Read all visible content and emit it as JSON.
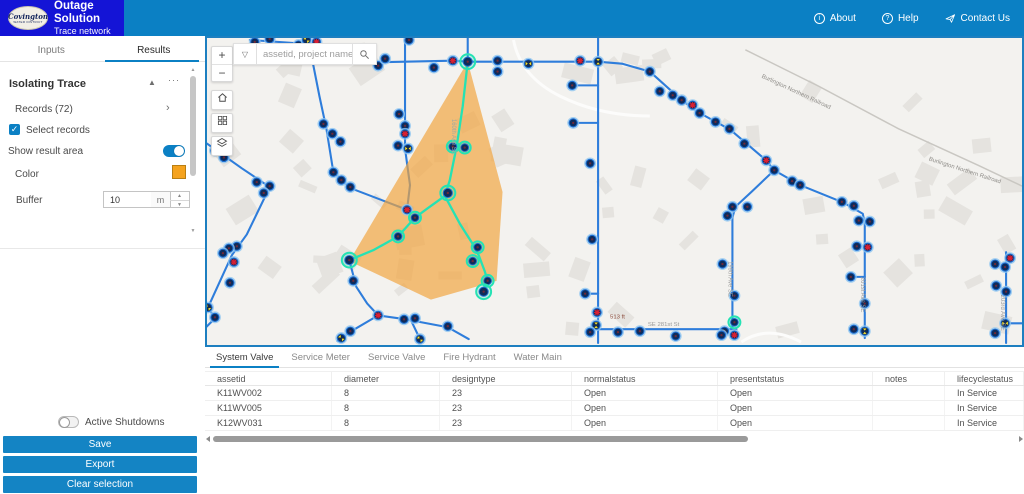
{
  "header": {
    "logo_line1": "Covington",
    "logo_line2": "WATER DISTRICT",
    "app_title": "Outage Solution",
    "app_subtitle": "Trace network",
    "links": [
      {
        "label": "About"
      },
      {
        "label": "Help"
      },
      {
        "label": "Contact Us"
      }
    ]
  },
  "sidebar": {
    "tabs": [
      {
        "label": "Inputs",
        "active": false
      },
      {
        "label": "Results",
        "active": true
      }
    ],
    "panel_title": "Isolating Trace",
    "records_label": "Records (72)",
    "select_records_label": "Select records",
    "select_records_checked": true,
    "show_result_area_label": "Show result area",
    "show_result_area_on": true,
    "color_label": "Color",
    "color_value": "#f5a31e",
    "buffer_label": "Buffer",
    "buffer_value": "10",
    "buffer_unit": "m",
    "active_shutdowns_label": "Active Shutdowns",
    "active_shutdowns_on": false,
    "buttons": [
      {
        "label": "Save"
      },
      {
        "label": "Export"
      },
      {
        "label": "Clear selection"
      }
    ]
  },
  "map": {
    "search_placeholder": "assetid, project name",
    "labels": [
      {
        "text": "Burlington Northern Railroad",
        "x": 762,
        "y": 76,
        "r": 25,
        "c": "#8f8d89"
      },
      {
        "text": "Burlington Northern Railroad",
        "x": 930,
        "y": 160,
        "r": 18,
        "c": "#8f8d89"
      },
      {
        "text": "SE 281st St",
        "x": 648,
        "y": 328,
        "r": 0,
        "c": "#9a9a9a"
      },
      {
        "text": "513 ft",
        "x": 610,
        "y": 320,
        "r": 0,
        "c": "#8a4a3a"
      },
      {
        "text": "SE 277th Pl",
        "x": 340,
        "y": 56,
        "r": 0,
        "c": "#a0a0a0"
      },
      {
        "text": "160th Ave SE",
        "x": 451,
        "y": 118,
        "r": 90,
        "c": "#a0a8a0"
      },
      {
        "text": "199th Ave SE",
        "x": 729,
        "y": 262,
        "r": 90,
        "c": "#9a9a9a"
      },
      {
        "text": "201st Ave SE",
        "x": 862,
        "y": 278,
        "r": 90,
        "c": "#9a9a9a"
      },
      {
        "text": "203rd Ave SE",
        "x": 1003,
        "y": 296,
        "r": 90,
        "c": "#9a9a9a"
      }
    ],
    "railroad": [
      [
        746,
        48
      ],
      [
        820,
        85
      ],
      [
        900,
        128
      ],
      [
        980,
        165
      ],
      [
        1024,
        186
      ]
    ],
    "roads": [
      "M513,38 Q520,75 560,95 T650,115",
      "M742,344 Q768,326 802,344"
    ],
    "polygon": [
      [
        467,
        60
      ],
      [
        502,
        192
      ],
      [
        496,
        282
      ],
      [
        430,
        301
      ],
      [
        348,
        262
      ]
    ],
    "lines": [
      [
        [
          358,
          61
        ],
        [
          452,
          59
        ],
        [
          467,
          60
        ],
        [
          598,
          60
        ],
        [
          622,
          62
        ]
      ],
      [
        [
          622,
          62
        ],
        [
          650,
          70
        ],
        [
          682,
          99
        ],
        [
          700,
          112
        ],
        [
          731,
          129
        ],
        [
          767,
          160
        ],
        [
          775,
          170
        ]
      ],
      [
        [
          775,
          170
        ],
        [
          801,
          185
        ],
        [
          845,
          203
        ],
        [
          864,
          214
        ],
        [
          866,
          224
        ],
        [
          866,
          340
        ]
      ],
      [
        [
          852,
          278
        ],
        [
          866,
          278
        ]
      ],
      [
        [
          775,
          170
        ],
        [
          752,
          192
        ],
        [
          736,
          207
        ],
        [
          733,
          218
        ],
        [
          733,
          331
        ]
      ],
      [
        [
          598,
          331
        ],
        [
          737,
          331
        ]
      ],
      [
        [
          598,
          36
        ],
        [
          598,
          345
        ]
      ],
      [
        [
          572,
          84
        ],
        [
          598,
          84
        ]
      ],
      [
        [
          573,
          122
        ],
        [
          598,
          122
        ]
      ],
      [
        [
          585,
          295
        ],
        [
          598,
          295
        ]
      ],
      [
        [
          467,
          36
        ],
        [
          467,
          60
        ]
      ],
      [
        [
          404,
          38
        ],
        [
          404,
          148
        ],
        [
          409,
          185
        ],
        [
          406,
          210
        ]
      ],
      [
        [
          308,
          44
        ],
        [
          318,
          95
        ],
        [
          325,
          128
        ],
        [
          332,
          172
        ],
        [
          349,
          188
        ],
        [
          406,
          210
        ]
      ],
      [
        [
          205,
          143
        ],
        [
          240,
          168
        ],
        [
          268,
          187
        ],
        [
          245,
          235
        ],
        [
          230,
          256
        ],
        [
          206,
          309
        ],
        [
          213,
          320
        ],
        [
          202,
          331
        ]
      ],
      [
        [
          248,
          38
        ],
        [
          320,
          43
        ]
      ],
      [
        [
          348,
          261
        ],
        [
          355,
          288
        ],
        [
          366,
          305
        ],
        [
          377,
          317
        ],
        [
          350,
          333
        ],
        [
          336,
          343
        ]
      ],
      [
        [
          377,
          317
        ],
        [
          405,
          321
        ],
        [
          447,
          329
        ],
        [
          468,
          341
        ]
      ],
      [
        [
          410,
          322
        ],
        [
          419,
          341
        ]
      ],
      [
        [
          1008,
          253
        ],
        [
          1008,
          345
        ]
      ],
      [
        [
          1008,
          325
        ],
        [
          1024,
          325
        ]
      ]
    ],
    "trace_lines": [
      [
        [
          467,
          60
        ],
        [
          462,
          105
        ],
        [
          456,
          145
        ],
        [
          449,
          180
        ],
        [
          444,
          196
        ]
      ],
      [
        [
          444,
          196
        ],
        [
          426,
          209
        ],
        [
          414,
          218
        ],
        [
          397,
          237
        ],
        [
          372,
          251
        ],
        [
          348,
          261
        ]
      ],
      [
        [
          444,
          196
        ],
        [
          459,
          224
        ],
        [
          471,
          243
        ],
        [
          478,
          256
        ],
        [
          484,
          272
        ],
        [
          487,
          282
        ],
        [
          483,
          294
        ]
      ]
    ],
    "nodes": [
      [
        253,
        40,
        "n"
      ],
      [
        268,
        37,
        "n"
      ],
      [
        297,
        43,
        "n"
      ],
      [
        305,
        38,
        "yd"
      ],
      [
        315,
        40,
        "x"
      ],
      [
        377,
        64,
        "n"
      ],
      [
        384,
        57,
        "n"
      ],
      [
        433,
        66,
        "n"
      ],
      [
        452,
        59,
        "x"
      ],
      [
        497,
        59,
        "n"
      ],
      [
        497,
        70,
        "n"
      ],
      [
        528,
        62,
        "yh"
      ],
      [
        580,
        59,
        "x"
      ],
      [
        598,
        60,
        "yv"
      ],
      [
        650,
        70,
        "n"
      ],
      [
        660,
        90,
        "n"
      ],
      [
        673,
        94,
        "n"
      ],
      [
        682,
        99,
        "n"
      ],
      [
        693,
        104,
        "x"
      ],
      [
        700,
        112,
        "n"
      ],
      [
        716,
        121,
        "n"
      ],
      [
        730,
        128,
        "n"
      ],
      [
        745,
        143,
        "n"
      ],
      [
        767,
        160,
        "x"
      ],
      [
        775,
        170,
        "n"
      ],
      [
        793,
        181,
        "n"
      ],
      [
        801,
        185,
        "n"
      ],
      [
        843,
        202,
        "n"
      ],
      [
        855,
        206,
        "n"
      ],
      [
        860,
        221,
        "n"
      ],
      [
        871,
        222,
        "n"
      ],
      [
        858,
        247,
        "n"
      ],
      [
        869,
        248,
        "x"
      ],
      [
        852,
        278,
        "n"
      ],
      [
        866,
        305,
        "n"
      ],
      [
        855,
        331,
        "n"
      ],
      [
        866,
        333,
        "yv"
      ],
      [
        733,
        207,
        "n"
      ],
      [
        748,
        207,
        "n"
      ],
      [
        728,
        216,
        "n"
      ],
      [
        723,
        265,
        "n"
      ],
      [
        735,
        297,
        "n"
      ],
      [
        735,
        324,
        "g"
      ],
      [
        725,
        333,
        "n"
      ],
      [
        735,
        337,
        "x"
      ],
      [
        618,
        334,
        "n"
      ],
      [
        640,
        333,
        "n"
      ],
      [
        676,
        338,
        "n"
      ],
      [
        722,
        337,
        "n"
      ],
      [
        572,
        84,
        "n"
      ],
      [
        573,
        122,
        "n"
      ],
      [
        590,
        163,
        "n"
      ],
      [
        592,
        240,
        "n"
      ],
      [
        585,
        295,
        "n"
      ],
      [
        597,
        314,
        "x"
      ],
      [
        596,
        327,
        "yv"
      ],
      [
        590,
        334,
        "n"
      ],
      [
        408,
        38,
        "n"
      ],
      [
        398,
        113,
        "n"
      ],
      [
        404,
        125,
        "n"
      ],
      [
        404,
        133,
        "x"
      ],
      [
        397,
        145,
        "n"
      ],
      [
        407,
        148,
        "yh"
      ],
      [
        322,
        123,
        "n"
      ],
      [
        331,
        133,
        "n"
      ],
      [
        339,
        141,
        "n"
      ],
      [
        332,
        172,
        "n"
      ],
      [
        340,
        180,
        "n"
      ],
      [
        349,
        187,
        "n"
      ],
      [
        406,
        210,
        "x"
      ],
      [
        213,
        150,
        "n"
      ],
      [
        222,
        157,
        "n"
      ],
      [
        255,
        182,
        "n"
      ],
      [
        268,
        186,
        "n"
      ],
      [
        262,
        193,
        "n"
      ],
      [
        235,
        247,
        "n"
      ],
      [
        227,
        249,
        "n"
      ],
      [
        221,
        254,
        "n"
      ],
      [
        232,
        263,
        "x"
      ],
      [
        228,
        284,
        "n"
      ],
      [
        206,
        309,
        "yd"
      ],
      [
        213,
        319,
        "n"
      ],
      [
        352,
        282,
        "n"
      ],
      [
        377,
        317,
        "x"
      ],
      [
        349,
        333,
        "n"
      ],
      [
        340,
        340,
        "yd"
      ],
      [
        403,
        321,
        "n"
      ],
      [
        414,
        320,
        "n"
      ],
      [
        447,
        328,
        "n"
      ],
      [
        419,
        341,
        "yd"
      ],
      [
        1012,
        259,
        "x"
      ],
      [
        997,
        265,
        "n"
      ],
      [
        1007,
        268,
        "n"
      ],
      [
        998,
        287,
        "n"
      ],
      [
        1008,
        293,
        "n"
      ],
      [
        1007,
        325,
        "yh"
      ],
      [
        997,
        335,
        "n"
      ],
      [
        467,
        60,
        "gb"
      ],
      [
        452,
        146,
        "g"
      ],
      [
        464,
        147,
        "g"
      ],
      [
        447,
        193,
        "gb"
      ],
      [
        414,
        218,
        "g"
      ],
      [
        397,
        237,
        "g"
      ],
      [
        348,
        261,
        "gb"
      ],
      [
        477,
        248,
        "g"
      ],
      [
        472,
        262,
        "g"
      ],
      [
        487,
        282,
        "g"
      ],
      [
        483,
        293,
        "gb"
      ]
    ]
  },
  "table": {
    "tabs": [
      {
        "label": "System Valve",
        "active": true
      },
      {
        "label": "Service Meter",
        "active": false
      },
      {
        "label": "Service Valve",
        "active": false
      },
      {
        "label": "Fire Hydrant",
        "active": false
      },
      {
        "label": "Water Main",
        "active": false
      }
    ],
    "columns": [
      "assetid",
      "diameter",
      "designtype",
      "normalstatus",
      "presentstatus",
      "notes",
      "lifecyclestatus"
    ],
    "col_widths": [
      127,
      108,
      132,
      146,
      155,
      72,
      79
    ],
    "rows": [
      [
        "K11WV002",
        "8",
        "23",
        "Open",
        "Open",
        "",
        "In Service"
      ],
      [
        "K11WV005",
        "8",
        "23",
        "Open",
        "Open",
        "",
        "In Service"
      ],
      [
        "K12WV031",
        "8",
        "23",
        "Open",
        "Open",
        "",
        "In Service"
      ]
    ]
  },
  "colors": {
    "accent": "#0b80c4",
    "trace": "#25e2b4",
    "area": "#f2a33c",
    "main_line": "#2e7ddb",
    "halo": "#8ec6f0",
    "node_fill": "#0d2c5c",
    "node_ring": "#1c6ed2",
    "red": "#dd1f31",
    "yellow": "#f2e23a",
    "map_bg": "#f3f2ef",
    "building": "#e5e3df",
    "railroad": "#c9c7c2"
  }
}
